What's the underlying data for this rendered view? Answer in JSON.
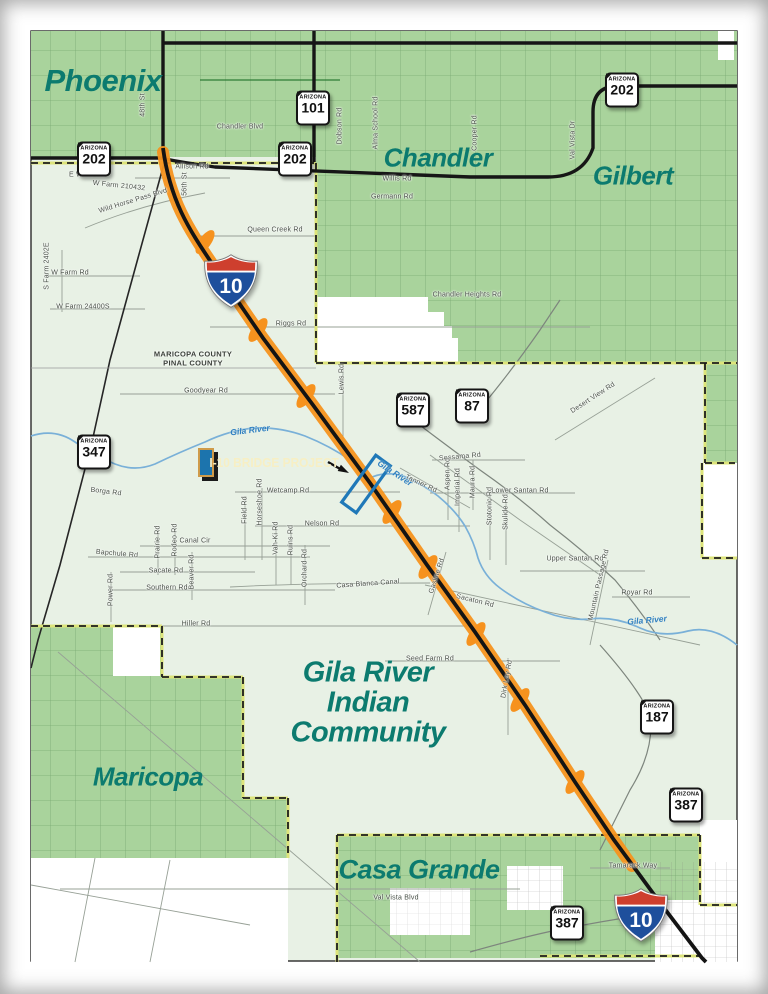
{
  "map": {
    "shield_caption": "ARIZONA",
    "callout": {
      "label": "I-10 BRIDGE PROJECT"
    },
    "county_label": {
      "lines": [
        "MARICOPA COUNTY",
        "PINAL COUNTY"
      ],
      "x": 193,
      "y": 354
    },
    "community_label": {
      "lines": [
        "Gila River",
        "Indian",
        "Community"
      ],
      "x": 368,
      "y": 673,
      "step": 30,
      "size": 29
    },
    "city_labels": [
      {
        "text": "Phoenix",
        "x": 103,
        "y": 81,
        "size": 31
      },
      {
        "text": "Chandler",
        "x": 438,
        "y": 158,
        "size": 26
      },
      {
        "text": "Gilbert",
        "x": 633,
        "y": 176,
        "size": 26
      },
      {
        "text": "Maricopa",
        "x": 148,
        "y": 777,
        "size": 26
      },
      {
        "text": "Casa Grande",
        "x": 419,
        "y": 870,
        "size": 27
      }
    ],
    "river_labels": [
      {
        "t": "Gila River",
        "x": 250,
        "y": 430,
        "r": -7
      },
      {
        "t": "Gila River",
        "x": 395,
        "y": 473,
        "r": 33
      },
      {
        "t": "Gila River",
        "x": 647,
        "y": 620,
        "r": -5
      }
    ],
    "road_labels": [
      {
        "t": "Chandler Blvd",
        "x": 240,
        "y": 127,
        "r": 0
      },
      {
        "t": "48th St",
        "x": 143,
        "y": 105,
        "r": -90
      },
      {
        "t": "Dobson Rd",
        "x": 340,
        "y": 126,
        "r": -90
      },
      {
        "t": "Alma School Rd",
        "x": 376,
        "y": 123,
        "r": -90
      },
      {
        "t": "Cooper Rd",
        "x": 475,
        "y": 133,
        "r": -90
      },
      {
        "t": "Val Vista Dr",
        "x": 573,
        "y": 140,
        "r": -90
      },
      {
        "t": "Willis Rd",
        "x": 397,
        "y": 179,
        "r": 0
      },
      {
        "t": "Germann Rd",
        "x": 392,
        "y": 197,
        "r": 0
      },
      {
        "t": "E Willis Rd",
        "x": 87,
        "y": 175,
        "r": 0
      },
      {
        "t": "W Farm 210432",
        "x": 119,
        "y": 186,
        "r": 6
      },
      {
        "t": "Wild Horse Pass Blvd",
        "x": 133,
        "y": 201,
        "r": -17
      },
      {
        "t": "Allison Rd",
        "x": 192,
        "y": 167,
        "r": 0
      },
      {
        "t": "56th St",
        "x": 185,
        "y": 184,
        "r": -90
      },
      {
        "t": "Queen Creek Rd",
        "x": 275,
        "y": 230,
        "r": 0
      },
      {
        "t": "Chandler Heights Rd",
        "x": 467,
        "y": 295,
        "r": 0
      },
      {
        "t": "Riggs Rd",
        "x": 291,
        "y": 324,
        "r": 0
      },
      {
        "t": "S Farm 2402E",
        "x": 47,
        "y": 266,
        "r": -90
      },
      {
        "t": "W Farm Rd",
        "x": 70,
        "y": 273,
        "r": 0
      },
      {
        "t": "W Farm 24400S",
        "x": 83,
        "y": 307,
        "r": 0
      },
      {
        "t": "Goodyear Rd",
        "x": 206,
        "y": 391,
        "r": 0
      },
      {
        "t": "Lewis Rd",
        "x": 342,
        "y": 379,
        "r": -90
      },
      {
        "t": "Desert View Rd",
        "x": 593,
        "y": 398,
        "r": -33
      },
      {
        "t": "Borga Rd",
        "x": 106,
        "y": 492,
        "r": 7
      },
      {
        "t": "Wetcamp Rd",
        "x": 288,
        "y": 491,
        "r": 0
      },
      {
        "t": "Field Rd",
        "x": 245,
        "y": 510,
        "r": -90
      },
      {
        "t": "Horseshoe Rd",
        "x": 260,
        "y": 502,
        "r": -90
      },
      {
        "t": "Nelson Rd",
        "x": 322,
        "y": 524,
        "r": 0
      },
      {
        "t": "Vah-Ki Rd",
        "x": 276,
        "y": 538,
        "r": -90
      },
      {
        "t": "Ruins Rd",
        "x": 291,
        "y": 540,
        "r": -90
      },
      {
        "t": "Canal Cir",
        "x": 195,
        "y": 541,
        "r": 0
      },
      {
        "t": "Prairie Rd",
        "x": 158,
        "y": 542,
        "r": -90
      },
      {
        "t": "Rodeo Rd",
        "x": 175,
        "y": 540,
        "r": -90
      },
      {
        "t": "Bapchule Rd",
        "x": 117,
        "y": 554,
        "r": 5
      },
      {
        "t": "Sacate Rd",
        "x": 166,
        "y": 571,
        "r": 0
      },
      {
        "t": "Beaver Rd",
        "x": 192,
        "y": 572,
        "r": -90
      },
      {
        "t": "Southern Rd",
        "x": 167,
        "y": 588,
        "r": 0
      },
      {
        "t": "Power Rd",
        "x": 111,
        "y": 590,
        "r": -90
      },
      {
        "t": "Hiller Rd",
        "x": 196,
        "y": 624,
        "r": 0
      },
      {
        "t": "Orchard Rd",
        "x": 305,
        "y": 568,
        "r": -90
      },
      {
        "t": "Casa Blanca Canal",
        "x": 368,
        "y": 584,
        "r": -4
      },
      {
        "t": "Gasline Rd",
        "x": 437,
        "y": 576,
        "r": -72
      },
      {
        "t": "Sacaton Rd",
        "x": 475,
        "y": 601,
        "r": 14
      },
      {
        "t": "Tanner Rd",
        "x": 421,
        "y": 484,
        "r": 25
      },
      {
        "t": "Sessama Rd",
        "x": 460,
        "y": 457,
        "r": -5
      },
      {
        "t": "Aspen Rd",
        "x": 448,
        "y": 474,
        "r": -90
      },
      {
        "t": "Imperial Rd",
        "x": 458,
        "y": 487,
        "r": -90
      },
      {
        "t": "Maura Rd",
        "x": 473,
        "y": 482,
        "r": -90
      },
      {
        "t": "Lower Santan Rd",
        "x": 520,
        "y": 491,
        "r": 0
      },
      {
        "t": "Stotonic Rd",
        "x": 490,
        "y": 506,
        "r": -90
      },
      {
        "t": "Skulide Rd",
        "x": 506,
        "y": 512,
        "r": -90
      },
      {
        "t": "Upper Santan Rd",
        "x": 575,
        "y": 559,
        "r": 0
      },
      {
        "t": "Mountain Passage Rd",
        "x": 599,
        "y": 585,
        "r": -77
      },
      {
        "t": "Royar Rd",
        "x": 637,
        "y": 593,
        "r": 0
      },
      {
        "t": "Seed Farm Rd",
        "x": 430,
        "y": 659,
        "r": 0
      },
      {
        "t": "Dirk Lay Rd",
        "x": 507,
        "y": 679,
        "r": -80
      },
      {
        "t": "Tamarack Way",
        "x": 633,
        "y": 866,
        "r": 0
      },
      {
        "t": "Val Vista Blvd",
        "x": 396,
        "y": 898,
        "r": 0
      }
    ],
    "shields": {
      "state": [
        {
          "n": "202",
          "x": 94,
          "y": 159
        },
        {
          "n": "202",
          "x": 295,
          "y": 159
        },
        {
          "n": "101",
          "x": 313,
          "y": 108
        },
        {
          "n": "202",
          "x": 622,
          "y": 90
        },
        {
          "n": "347",
          "x": 94,
          "y": 452
        },
        {
          "n": "587",
          "x": 413,
          "y": 410
        },
        {
          "n": "87",
          "x": 472,
          "y": 406
        },
        {
          "n": "187",
          "x": 657,
          "y": 717
        },
        {
          "n": "387",
          "x": 686,
          "y": 805
        },
        {
          "n": "387",
          "x": 567,
          "y": 923
        }
      ],
      "interstate": [
        {
          "n": "10",
          "x": 231,
          "y": 281,
          "w": 58
        },
        {
          "n": "10",
          "x": 641,
          "y": 915,
          "w": 58
        }
      ]
    },
    "colors": {
      "city_fill": "#a9d39c",
      "land_fill": "#e8f1e5",
      "teal_text": "#0c7b6f",
      "corridor_orange": "#f6921e",
      "river_blue": "#79b0d8",
      "callout_bg": "#1c74ad",
      "callout_text": "#f7efc4",
      "boundary_underlay": "#dde47a",
      "interstate_red": "#ce3f2e",
      "interstate_blue": "#1e4f9c"
    }
  }
}
